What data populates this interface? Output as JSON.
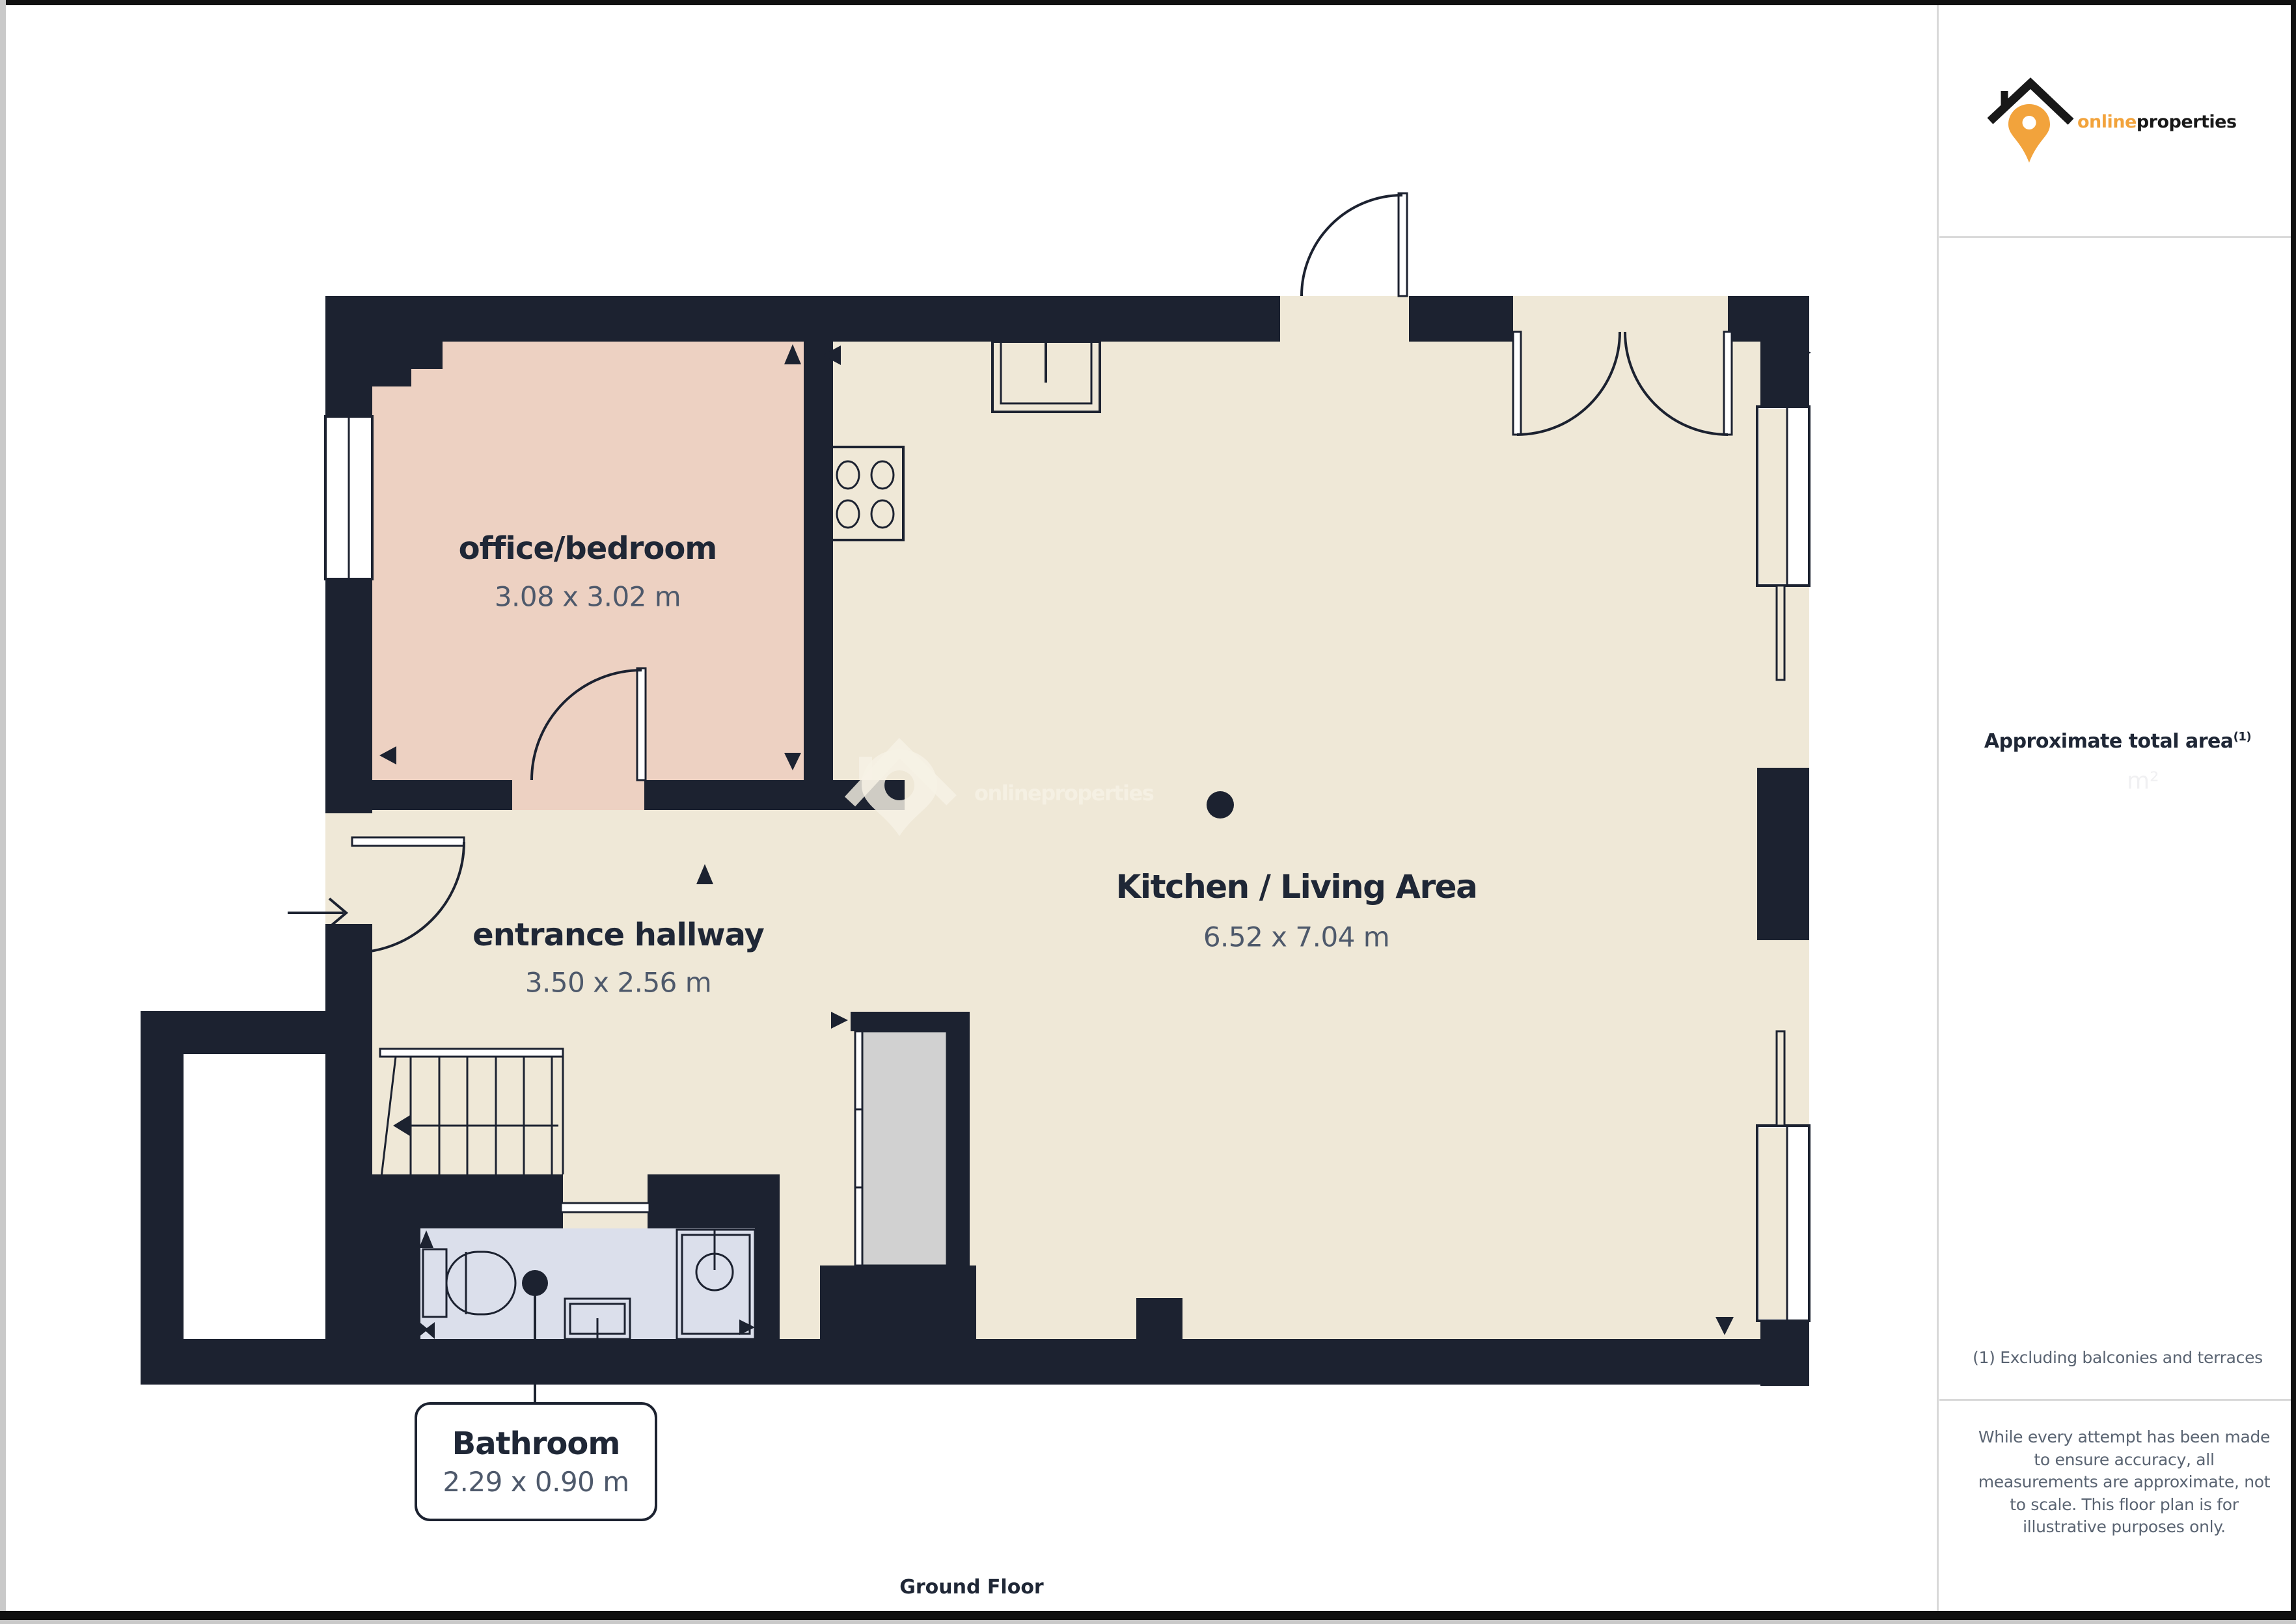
{
  "plan": {
    "rooms": [
      {
        "name": "office/bedroom",
        "dims": "3.08 x 3.02 m"
      },
      {
        "name": "entrance hallway",
        "dims": "3.50 x 2.56 m"
      },
      {
        "name": "Kitchen / Living Area",
        "dims": "6.52 x 7.04 m"
      },
      {
        "name": "Bathroom",
        "dims": "2.29 x 0.90 m"
      }
    ],
    "floor_label": "Ground Floor"
  },
  "watermark": {
    "text": "onlineproperties"
  },
  "sidebar": {
    "logo": {
      "online": "online",
      "properties": "properties"
    },
    "area_title": "Approximate total area",
    "area_superscript": "(1)",
    "area_ghost": "m²",
    "footnote": "(1) Excluding balconies and terraces",
    "disclaimer": "While every attempt has been made to ensure accuracy, all measurements are approximate, not to scale. This floor plan is for illustrative purposes only."
  },
  "colors": {
    "wall": "#1c2230",
    "floor": "#efe8d7",
    "office": "#edd1c2",
    "bathroom": "#dbdfeb",
    "cupboard": "#d1d1d1",
    "heading": "#1f2736",
    "dims": "#4e596b",
    "muted": "#5a6472",
    "accent": "#f2a33c",
    "divider": "#d9d9d9"
  }
}
